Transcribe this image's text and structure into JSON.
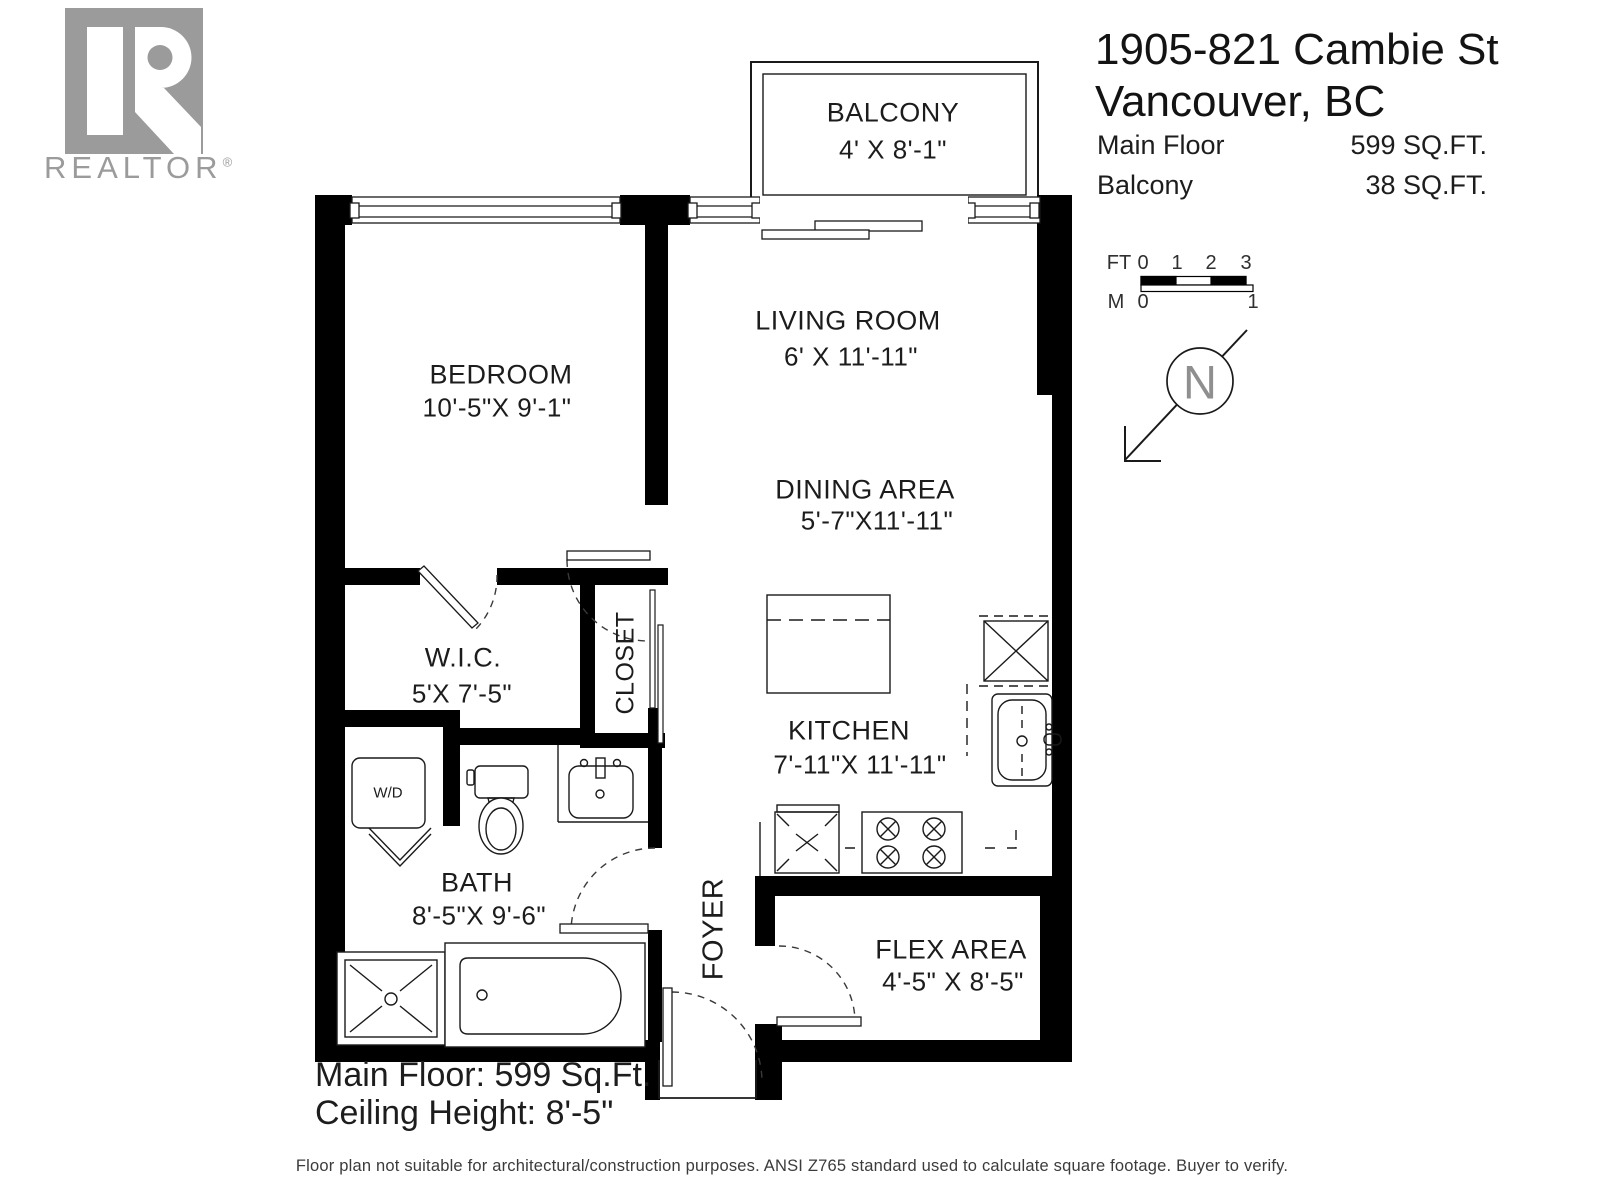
{
  "branding": {
    "logo_text": "REALTOR",
    "registered_mark": "®"
  },
  "header": {
    "address_line1": "1905-821 Cambie St",
    "address_line2": "Vancouver, BC",
    "areas": [
      {
        "label": "Main Floor",
        "value": "599 SQ.FT."
      },
      {
        "label": "Balcony",
        "value": "38 SQ.FT."
      }
    ]
  },
  "scale_bar": {
    "ft_label": "FT",
    "m_label": "M",
    "ft_ticks": [
      "0",
      "1",
      "2",
      "3"
    ],
    "m_ticks": [
      "0",
      "1"
    ]
  },
  "compass": {
    "letter": "N"
  },
  "rooms": {
    "balcony": {
      "name": "BALCONY",
      "dims": "4' X 8'-1\""
    },
    "living_room": {
      "name": "LIVING ROOM",
      "dims": "6' X 11'-11\""
    },
    "dining_area": {
      "name": "DINING AREA",
      "dims": "5'-7\"X11'-11\""
    },
    "bedroom": {
      "name": "BEDROOM",
      "dims": "10'-5\"X 9'-1\""
    },
    "wic": {
      "name": "W.I.C.",
      "dims": "5'X 7'-5\""
    },
    "closet": {
      "name": "CLOSET"
    },
    "kitchen": {
      "name": "KITCHEN",
      "dims": "7'-11\"X 11'-11\""
    },
    "bath": {
      "name": "BATH",
      "dims": "8'-5\"X 9'-6\""
    },
    "foyer": {
      "name": "FOYER"
    },
    "flex_area": {
      "name": "FLEX AREA",
      "dims": "4'-5\" X 8'-5\""
    }
  },
  "fixtures": {
    "washer_dryer": "W/D"
  },
  "summary": {
    "line1": "Main Floor: 599 Sq.Ft.",
    "line2": "Ceiling Height: 8'-5\""
  },
  "footer": {
    "disclaimer": "Floor plan not suitable for architectural/construction purposes. ANSI Z765 standard used to calculate square footage. Buyer to verify."
  },
  "colors": {
    "wall": "#000000",
    "logo_gray": "#9b9b9b",
    "text_dark": "#1c1c1c",
    "compass_gray": "#8f8f8f"
  }
}
